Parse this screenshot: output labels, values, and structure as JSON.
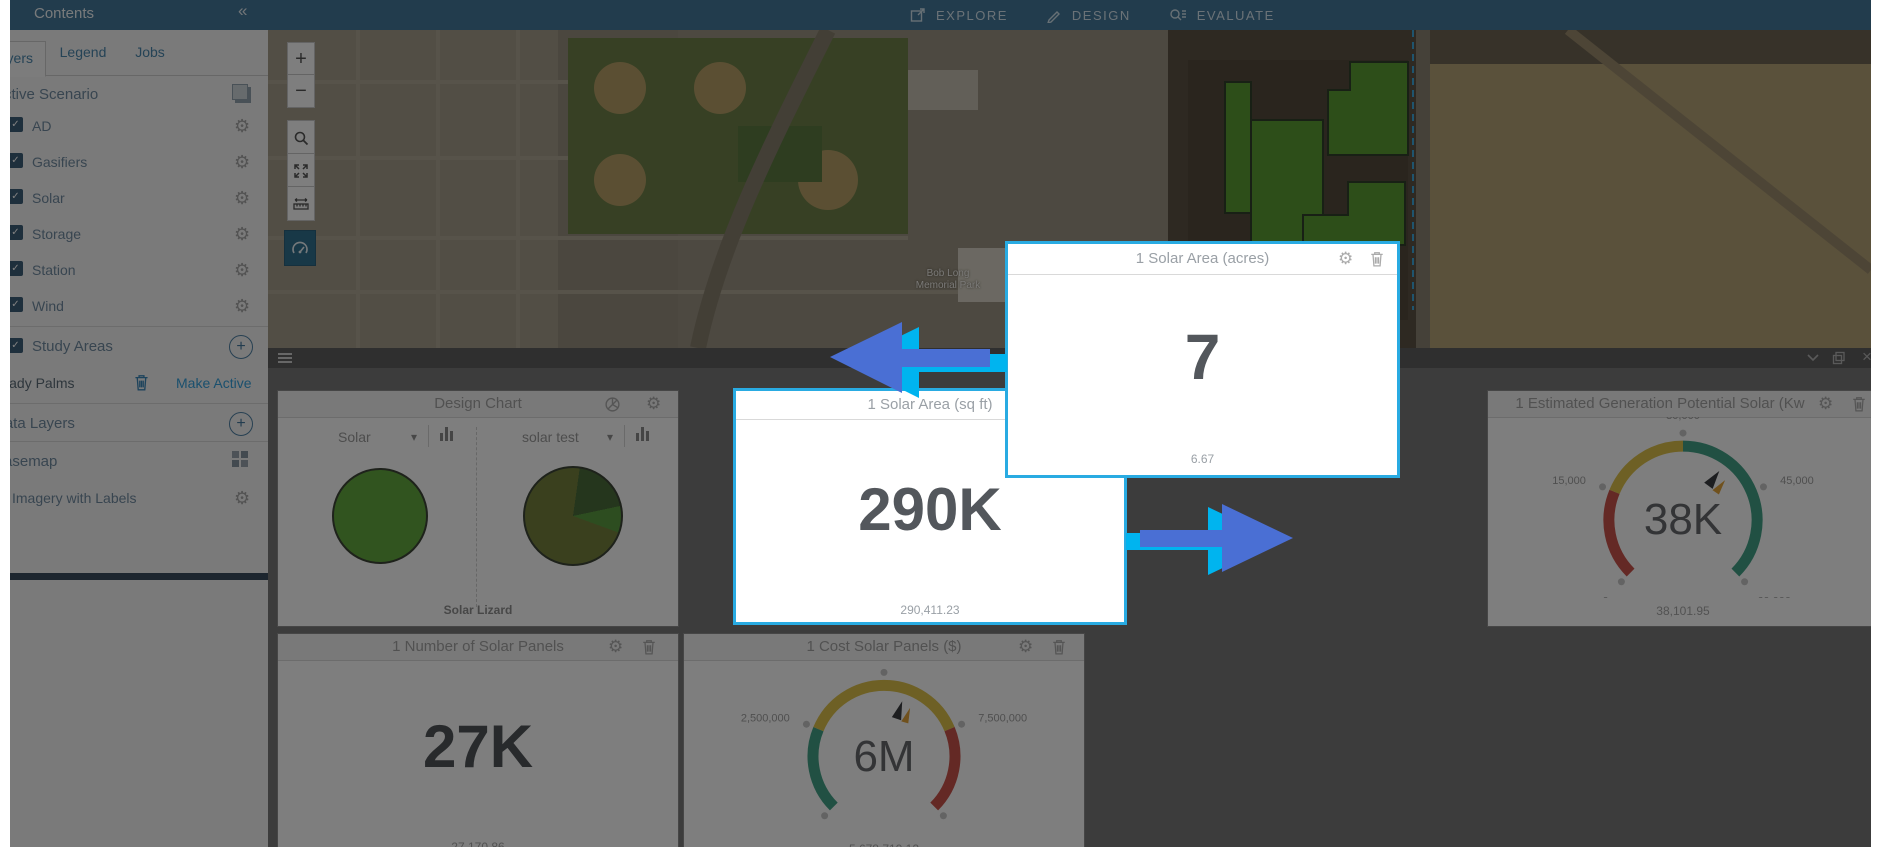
{
  "colors": {
    "topbar-bg": "#45789a",
    "highlight-border": "#29abe2",
    "arrow-blue": "#4a6fd4",
    "arrow-cyan": "#00b4ef",
    "polygon-green": "#5a9c33",
    "link-blue": "#35a0dc",
    "active-tool-bg": "#31708e"
  },
  "topbar": {
    "contents": "Contents",
    "collapse": "«",
    "nav": [
      {
        "label": "EXPLORE"
      },
      {
        "label": "DESIGN"
      },
      {
        "label": "EVALUATE"
      }
    ]
  },
  "sidebar": {
    "tabs": [
      {
        "label": "Layers"
      },
      {
        "label": "Legend"
      },
      {
        "label": "Jobs"
      }
    ],
    "active_tab": "Layers",
    "active_scenario": "Active Scenario",
    "layers": [
      {
        "label": "AD"
      },
      {
        "label": "Gasifiers"
      },
      {
        "label": "Solar"
      },
      {
        "label": "Storage"
      },
      {
        "label": "Station"
      },
      {
        "label": "Wind"
      }
    ],
    "study_areas": "Study Areas",
    "scenario": {
      "name": "Shady Palms",
      "action": "Make Active"
    },
    "data_layers": "Data Layers",
    "basemap": "Basemap",
    "basemap_layer": "Imagery with Labels",
    "checkmark": "✓",
    "plus": "+"
  },
  "map": {
    "zoom_in": "+",
    "zoom_out": "−",
    "park_label_line1": "Bob Long",
    "park_label_line2": "Memorial Park"
  },
  "dashboard": {
    "design_chart": {
      "title": "Design Chart",
      "left_select": "Solar",
      "right_select": "solar test",
      "footer": "Solar Lizard"
    },
    "sqft": {
      "title": "1 Solar Area (sq ft)",
      "display": "290K",
      "exact": "290,411.23"
    },
    "acres": {
      "title": "1 Solar Area (acres)",
      "display": "7",
      "exact": "6.67"
    },
    "generation": {
      "title": "1 Estimated Generation Potential Solar (Kw",
      "display": "38K",
      "exact": "38,101.95"
    },
    "panels": {
      "title": "1 Number of Solar Panels",
      "display": "27K",
      "exact": "27,170.86"
    },
    "cost": {
      "title": "1 Cost Solar Panels ($)",
      "display": "6M",
      "exact": "5,678,710.12"
    }
  },
  "chart_data": [
    {
      "type": "pie",
      "title": "Solar",
      "slices": [
        {
          "label": "Solar",
          "deg": 360,
          "color": "#63a83e"
        }
      ]
    },
    {
      "type": "pie",
      "title": "solar test",
      "slices": [
        {
          "label": "segment-olive",
          "deg": 8,
          "color": "#74803c"
        },
        {
          "label": "segment-dark-green",
          "deg": 70,
          "color": "#4b6c3a"
        },
        {
          "label": "segment-bright-green",
          "deg": 32,
          "color": "#5a9a40"
        },
        {
          "label": "segment-olive",
          "deg": 250,
          "color": "#74803c"
        }
      ]
    },
    {
      "type": "gauge",
      "title": "1 Estimated Generation Potential Solar (Kw",
      "min": 0,
      "max": 60000,
      "value": 38101.95,
      "display": "38K",
      "start_deg": 225,
      "sweep_deg": 270,
      "ticks": [
        {
          "v": 0,
          "label": "0"
        },
        {
          "v": 15000,
          "label": "15,000"
        },
        {
          "v": 30000,
          "label": "30,000"
        },
        {
          "v": 45000,
          "label": "45,000"
        },
        {
          "v": 60000,
          "label": "60,000"
        }
      ],
      "segments": [
        {
          "from": 0,
          "to": 15000,
          "color": "#c9534b"
        },
        {
          "from": 15000,
          "to": 30000,
          "color": "#ddc04a"
        },
        {
          "from": 30000,
          "to": 60000,
          "color": "#43a186"
        }
      ]
    },
    {
      "type": "gauge",
      "title": "1 Cost Solar Panels ($)",
      "min": 0,
      "max": 10000000,
      "value": 5678710.12,
      "display": "6M",
      "start_deg": 225,
      "sweep_deg": 270,
      "ticks": [
        {
          "v": 0,
          "label": "0"
        },
        {
          "v": 2500000,
          "label": "2,500,000"
        },
        {
          "v": 5000000,
          "label": "5,000,000"
        },
        {
          "v": 7500000,
          "label": "7,500,000"
        },
        {
          "v": 10000000,
          "label": "10,000,000"
        }
      ],
      "segments": [
        {
          "from": 0,
          "to": 2500000,
          "color": "#43a186"
        },
        {
          "from": 2500000,
          "to": 7500000,
          "color": "#ddc04a"
        },
        {
          "from": 7500000,
          "to": 10000000,
          "color": "#c9534b"
        }
      ]
    }
  ]
}
